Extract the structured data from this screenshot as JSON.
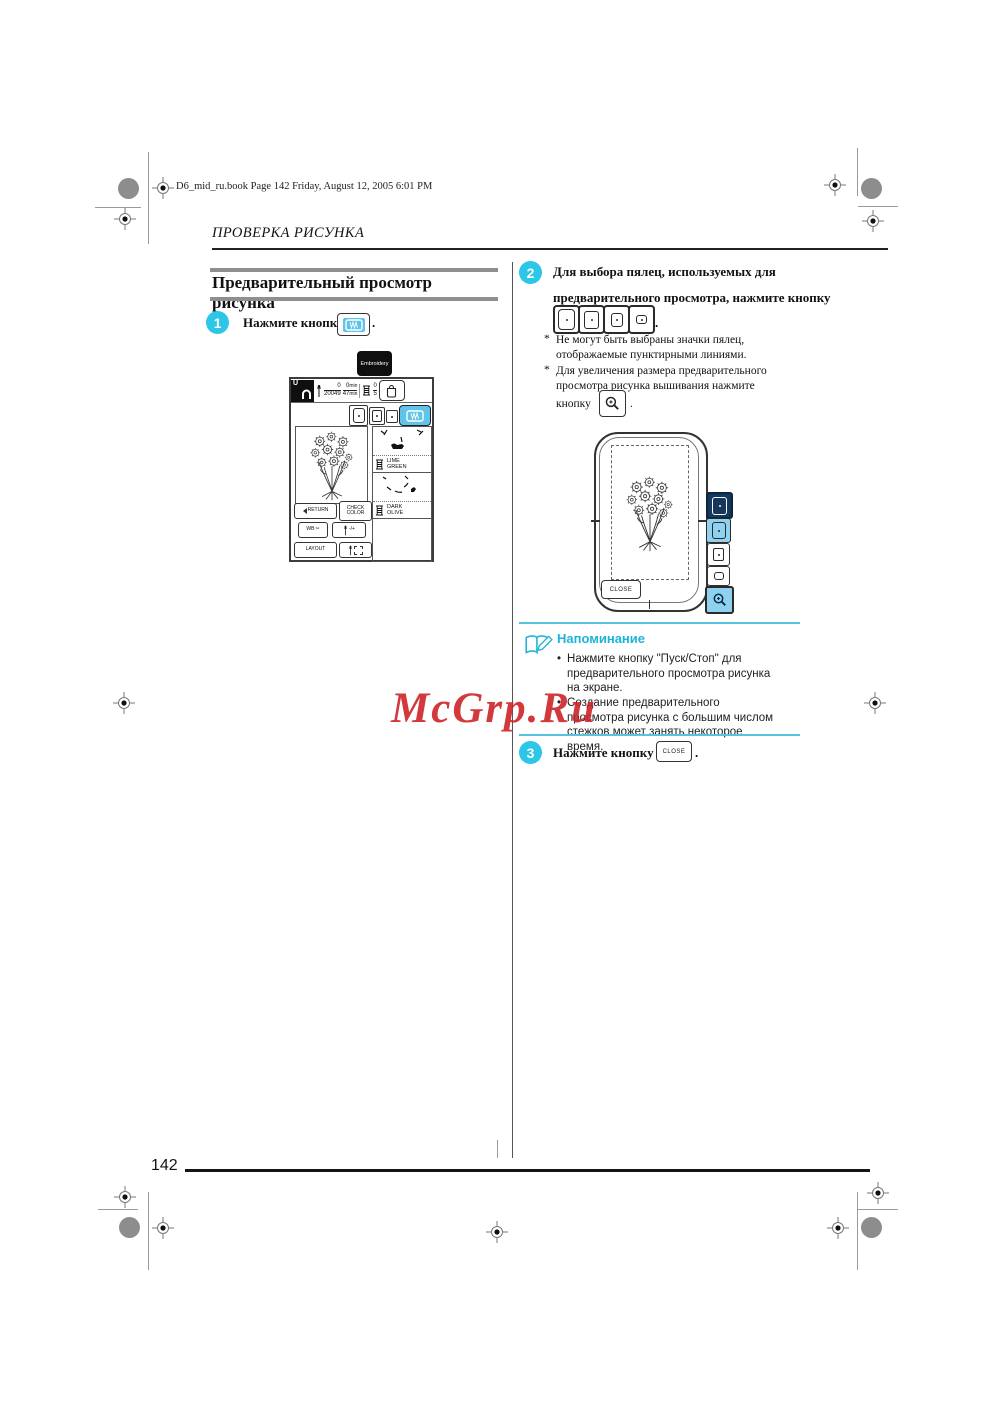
{
  "page": {
    "print_header": "D6_mid_ru.book  Page 142  Friday, August 12, 2005  6:01 PM",
    "running_head": "ПРОВЕРКА РИСУНКА",
    "page_number": "142",
    "watermark": "McGrp.Ru"
  },
  "colors": {
    "accent_cyan": "#2cc6e6",
    "watermark_red": "#cd2428",
    "bar_gray": "#8f8f8f",
    "screen_blue": "#5fc3ea",
    "selected_navy": "#16375c"
  },
  "section": {
    "title": "Предварительный просмотр рисунка"
  },
  "step1": {
    "num": "1",
    "text": "Нажмите кнопку",
    "period": "."
  },
  "screen": {
    "tab": "Embroidery",
    "unit_label": "U",
    "stitch_num": "0",
    "stitch_den": "20049",
    "time_num": "0",
    "time_den": "47",
    "time_unit_top": "min",
    "time_unit_bottom": "min",
    "spool_num": "0",
    "spool_den": "5",
    "btn_return": "RETURN",
    "btn_check_line1": "CHECK",
    "btn_check_line2": "COLOR",
    "btn_trim": "WB",
    "btn_density": "-/+",
    "btn_layout": "LAYOUT",
    "thread1_line1": "LIME",
    "thread1_line2": "GREEN",
    "thread2_line1": "DARK",
    "thread2_line2": "OLIVE"
  },
  "icons": {
    "scissors": "✂"
  },
  "step2": {
    "num": "2",
    "line1": "Для выбора пялец, используемых для",
    "line2": "предварительного просмотра, нажмите кнопку",
    "period": ".",
    "asterisk": "*",
    "note1": "Не могут быть выбраны значки пялец, отображаемые пунктирными линиями.",
    "note2": "Для увеличения размера предварительного просмотра рисунка вышивания нажмите",
    "note2_suffix": "кнопку",
    "note2_period": "."
  },
  "preview": {
    "close_label": "CLOSE"
  },
  "reminder": {
    "title": "Напоминание",
    "items": [
      "Нажмите кнопку \"Пуск/Стоп\" для предварительного просмотра рисунка на экране.",
      "Создание предварительного просмотра рисунка с большим числом стежков может занять некоторое время."
    ]
  },
  "step3": {
    "num": "3",
    "text": "Нажмите кнопку",
    "button_label": "CLOSE",
    "period": "."
  }
}
